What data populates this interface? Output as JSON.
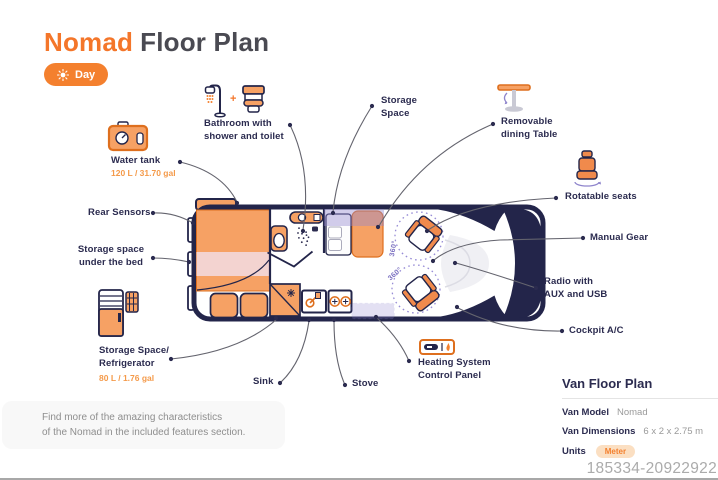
{
  "title": {
    "brand": "Nomad",
    "rest": "Floor Plan"
  },
  "mode_button": {
    "label": "Day",
    "icon": "sun"
  },
  "callouts": {
    "water_tank": {
      "title": "Water tank",
      "capacity": "120 L / 31.70 gal",
      "icon": "water-tank"
    },
    "bathroom": {
      "line1": "Bathroom with",
      "line2": "shower and toilet",
      "icons": "shower + toilet",
      "plus": "+"
    },
    "storage_space": {
      "line1": "Storage",
      "line2": "Space"
    },
    "dining_table": {
      "line1": "Removable",
      "line2": "dining Table",
      "icon": "pedestal-table"
    },
    "rotatable_seats": {
      "title": "Rotatable seats",
      "icon": "swivel-seat"
    },
    "manual_gear": {
      "title": "Manual Gear"
    },
    "radio": {
      "line1": "Radio with",
      "line2": "AUX and USB"
    },
    "cockpit_ac": {
      "title": "Cockpit A/C"
    },
    "heating": {
      "line1": "Heating System",
      "line2": "Control Panel",
      "icon": "control-panel"
    },
    "stove": {
      "title": "Stove"
    },
    "sink": {
      "title": "Sink"
    },
    "fridge": {
      "line1": "Storage Space/",
      "line2": "Refrigerator",
      "capacity": "80 L / 1.76 gal",
      "icon": "refrigerator"
    },
    "storage_under_bed": {
      "line1": "Storage space",
      "line2": "under the bed"
    },
    "rear_sensors": {
      "title": "Rear Sensors"
    }
  },
  "floorplan": {
    "rotation_badges": [
      "360°",
      "360°"
    ]
  },
  "footer_note": {
    "line1": "Find more of the amazing characteristics",
    "line2": "of the Nomad in the included features section."
  },
  "spec_panel": {
    "title": "Van Floor Plan",
    "rows": [
      {
        "label": "Van Model",
        "value": "Nomad"
      },
      {
        "label": "Van Dimensions",
        "value": "6 x 2 x 2.75 m"
      },
      {
        "label": "Units",
        "value": "Meter"
      }
    ]
  },
  "watermark": "185334-20922922",
  "colors": {
    "accent": "#F4762A",
    "accent_light": "#F6A164",
    "navy": "#23254A",
    "purple": "#8F85CC",
    "pink": "#F3D3D0",
    "value_orange": "#F49A4A"
  }
}
